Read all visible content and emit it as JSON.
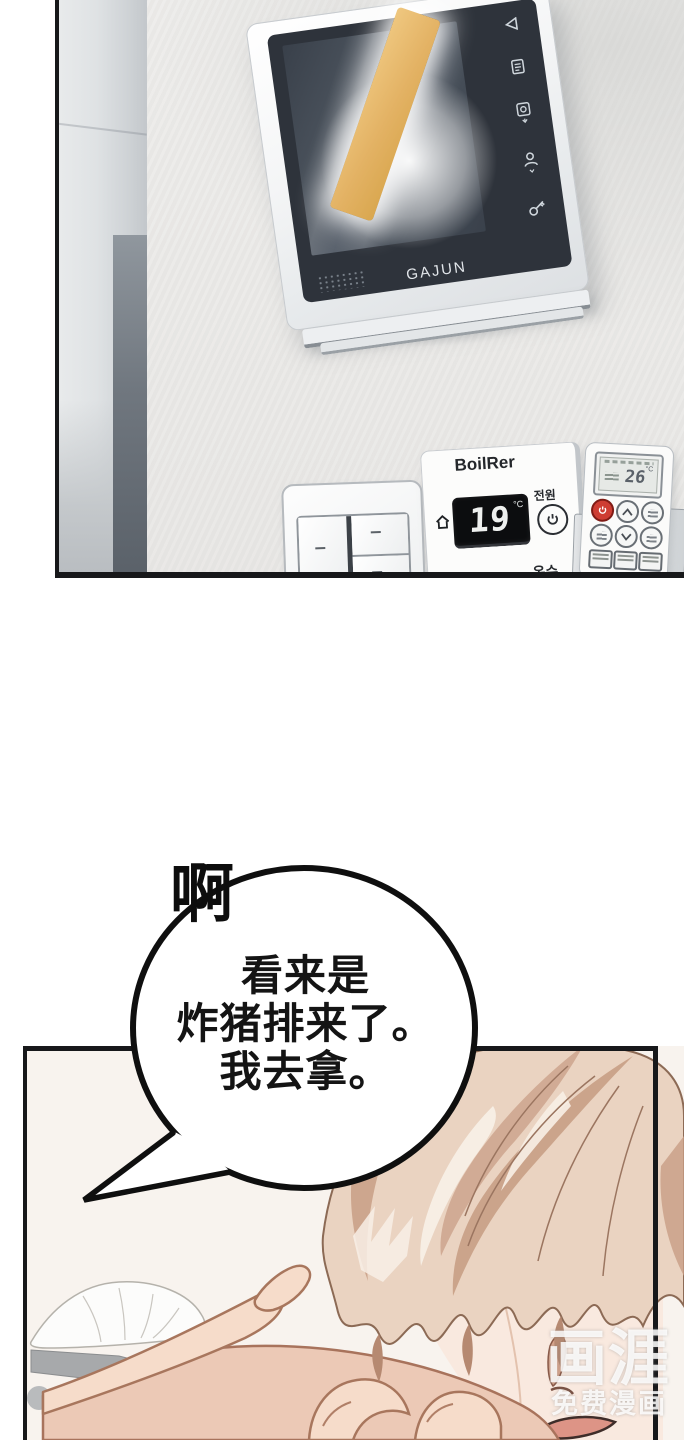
{
  "panel_top": {
    "intercom": {
      "brand": "GAJUN"
    },
    "boiler": {
      "title": "BoilRer",
      "temperature": "19",
      "unit": "°C",
      "power_label": "전원",
      "heating_label": "난방",
      "hot_water_label": "온수"
    },
    "remote": {
      "temperature": "26",
      "unit": "°C"
    }
  },
  "panel_bottom": {
    "sfx": "啊",
    "speech": {
      "lines": [
        "看来是",
        "炸猪排来了。",
        "我去拿。"
      ]
    },
    "watermark": {
      "logo": "画涯",
      "tagline": "免费漫画"
    }
  },
  "icons": {
    "intercom": [
      "back-triangle-icon",
      "memo-icon",
      "door-release-icon",
      "visitor-icon",
      "key-icon"
    ],
    "boiler": [
      "home-icon",
      "power-icon"
    ],
    "remote": [
      "power-icon",
      "chevron-up-icon",
      "chevron-down-icon"
    ]
  },
  "colors": {
    "highlight_stick": "#e5b668",
    "wall": "#eae9e7",
    "hair_base": "#ead3c1",
    "hair_shadow": "#c89e85",
    "skin_hand": "#f6dcca",
    "skin_face": "#f9e9df",
    "arm": "#ecc9b6",
    "remote_power_red": "#ce3d33",
    "panel_border": "#17181a"
  }
}
